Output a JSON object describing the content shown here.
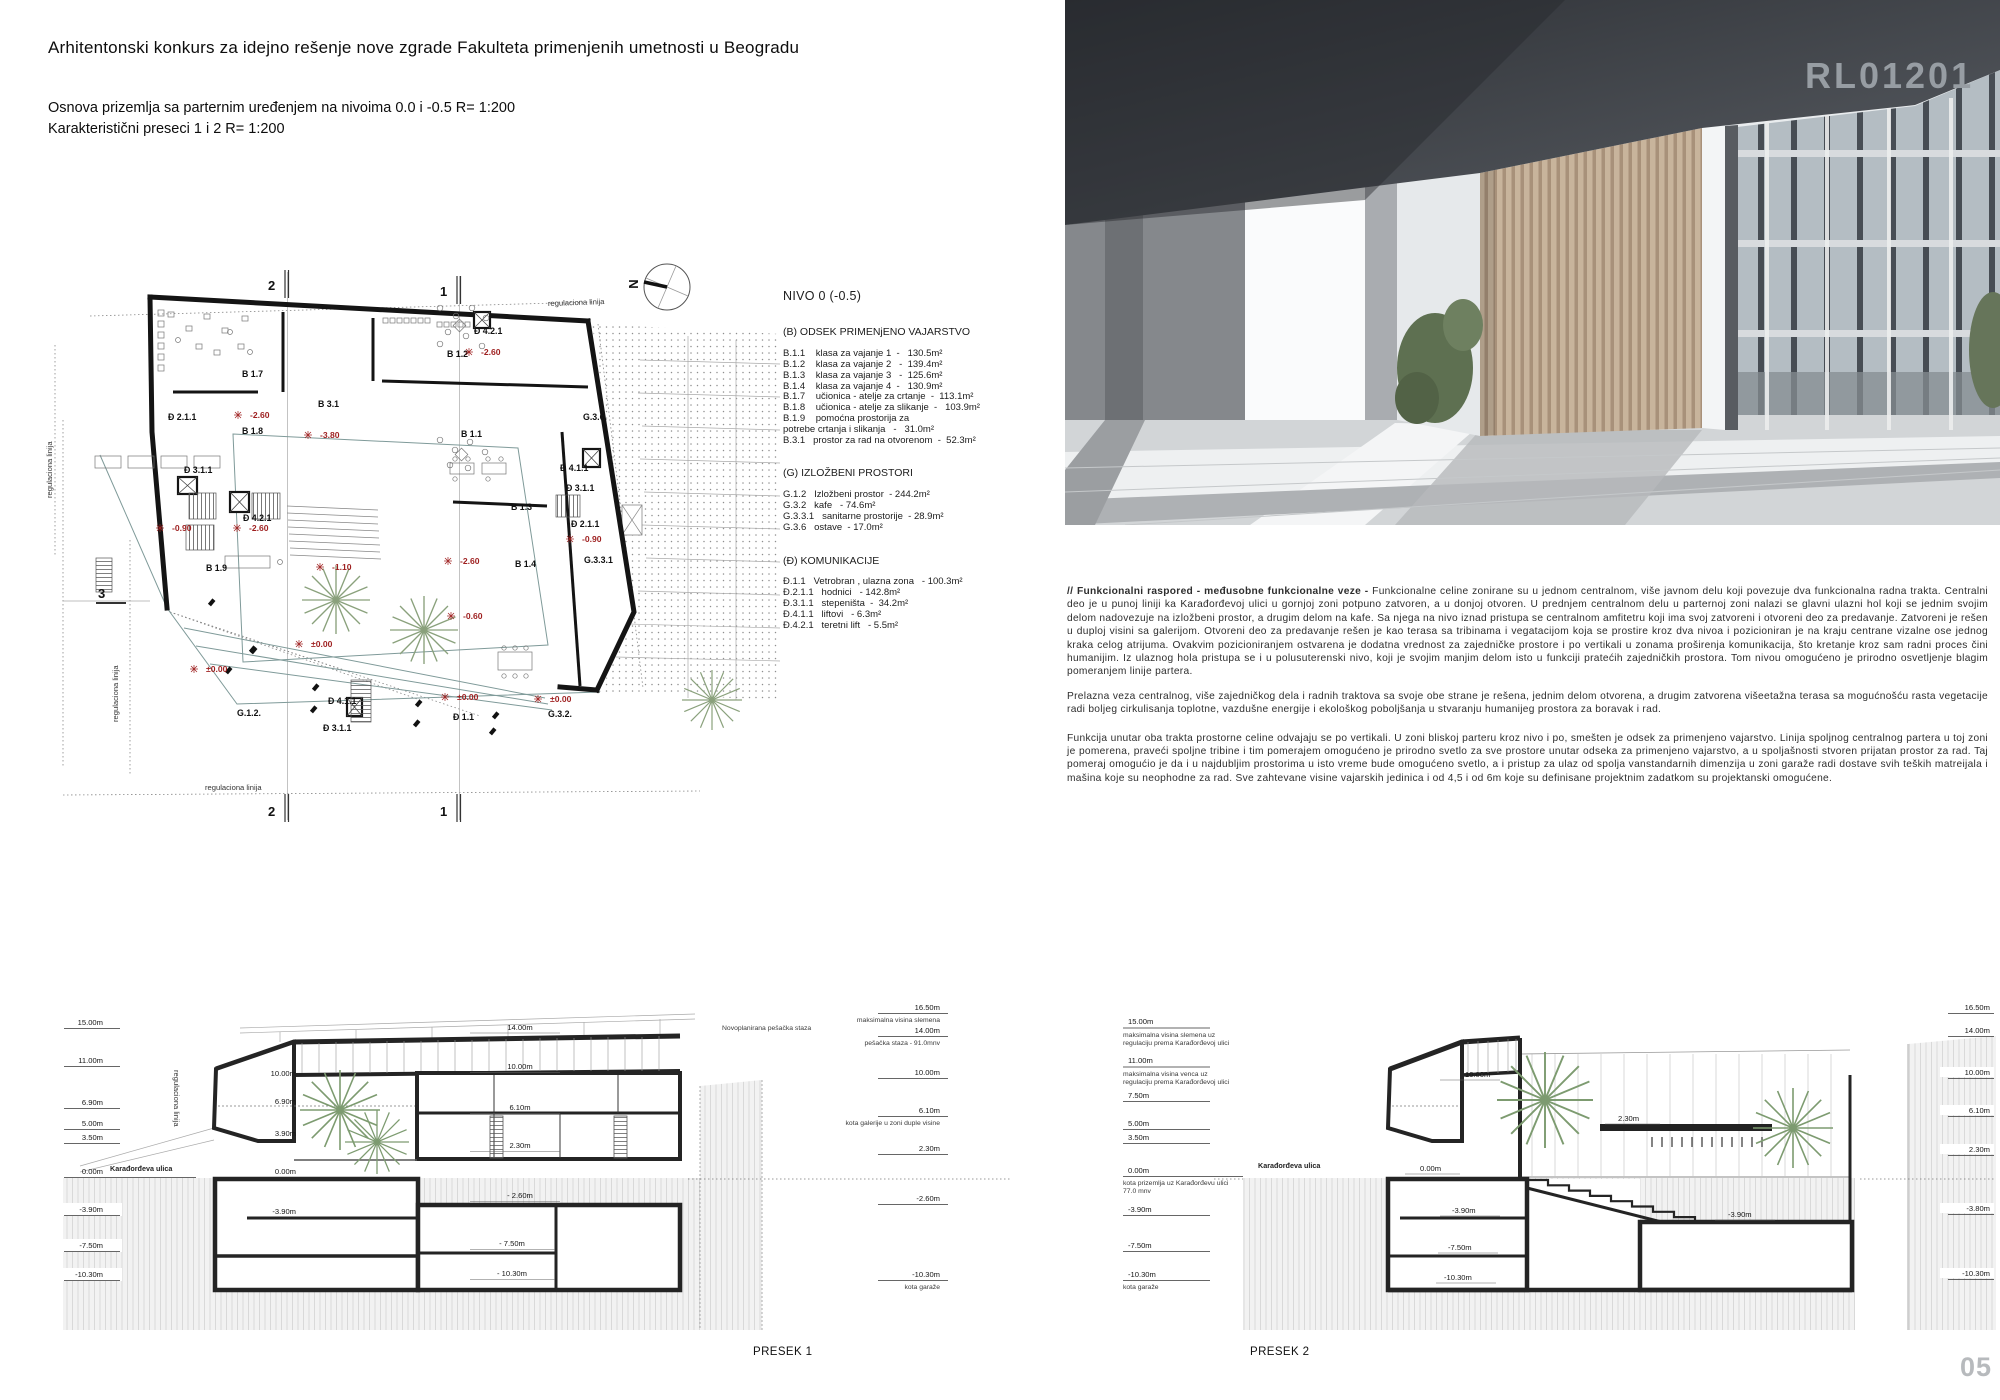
{
  "page": {
    "number": "05"
  },
  "photo": {
    "code": "RL01201"
  },
  "header": {
    "title": "Arhitentonski konkurs za idejno rešenje nove zgrade Fakulteta primenjenih umetnosti u Beogradu",
    "line1": "Osnova prizemlja sa parternim uređenjem na nivoima 0.0 i -0.5    R= 1:200",
    "line2": "Karakteristični preseci 1 i 2     R= 1:200"
  },
  "plan": {
    "compass": "N",
    "reg_label": "regulaciona linija",
    "markers": {
      "m1": "1",
      "m2": "2",
      "m3": "3"
    },
    "rooms": [
      "B 1.7",
      "Đ 2.1.1",
      "B 1.8",
      "B 3.1",
      "B 1.2",
      "Đ 4.2.1",
      "B 1.1",
      "G.3.6.",
      "Đ 4.1.1",
      "Đ 3.1.1",
      "B 1.3",
      "Đ 2.1.1",
      "G.3.3.1",
      "B 1.4",
      "Đ 3.1.1",
      "Đ 4.2.1",
      "B 1.9",
      "G.1.2.",
      "Đ 4.1.1",
      "Đ 3.1.1",
      "Đ 1.1",
      "G.3.2."
    ],
    "levels": [
      "-2.60",
      "-3.80",
      "-2.60",
      "-0.90",
      "-2.60",
      "-0.60",
      "-0.90",
      "-2.60",
      "-1.10",
      "±0.00",
      "±0.00",
      "±0.00",
      "±0.00"
    ]
  },
  "program": {
    "title": "NIVO  0  (-0.5)",
    "b_heading": "(B) ODSEK PRIMENjENO VAJARSTVO",
    "b_items": [
      "B.1.1    klasa za vajanje 1  -   130.5m²",
      "B.1.2    klasa za vajanje 2   -  139.4m²",
      "B.1.3    klasa za vajanje 3   -  125.6m²",
      "B.1.4    klasa za vajanje 4  -   130.9m²",
      "B.1.7    učionica - atelje za crtanje  -  113.1m²",
      "B.1.8    učionica - atelje za slikanje  -   103.9m²",
      "B.1.9    pomoćna prostorija za",
      "potrebe crtanja i slikanja   -   31.0m²",
      "B.3.1   prostor za rad na otvorenom  -  52.3m²"
    ],
    "g_heading": "(G) IZLOŽBENI PROSTORI",
    "g_items": [
      "G.1.2   Izložbeni prostor  - 244.2m²",
      "G.3.2   kafe   - 74.6m²",
      "G.3.3.1   sanitarne prostorije  - 28.9m²",
      "G.3.6   ostave  - 17.0m²"
    ],
    "d_heading": "(Đ) KOMUNIKACIJE",
    "d_items": [
      "Đ.1.1   Vetrobran , ulazna zona   - 100.3m²",
      "Đ.2.1.1   hodnici   - 142.8m²",
      "Đ.3.1.1   stepeništa  -  34.2m²",
      "Đ.4.1.1   liftovi   - 6.3m²",
      "Đ.4.2.1   teretni lift   - 5.5m²"
    ]
  },
  "essay": {
    "lead": "//  Funkcionalni raspored - međusobne funkcionalne veze - ",
    "p1_rest": "Funkcionalne celine zonirane su u jednom centralnom, više javnom delu koji povezuje dva funkcionalna radna trakta. Centralni deo je u punoj liniji ka Karađorđevoj ulici u gornjoj zoni potpuno zatvoren, a u donjoj otvoren. U prednjem centralnom delu u parternoj zoni nalazi se glavni ulazni hol koji se jednim svojim delom nadovezuje na izložbeni prostor, a drugim delom na kafe. Sa njega na nivo iznad pristupa se centralnom amfitetru koji ima svoj zatvoreni i otvoreni deo za predavanje. Zatvoreni je rešen u duploj visini sa galerijom. Otvoreni deo za predavanje rešen je kao terasa sa tribinama i vegatacijom koja se prostire  kroz dva nivoa i pozicioniran je na kraju centrane vizalne ose jednog kraka celog atrijuma. Ovakvim pozicioniranjem ostvarena je dodatna vrednost za zajedničke prostore i po vertikali u zonama proširenja komunikacija, što kretanje kroz sam radni proces čini humanijim.  Iz ulaznog hola pristupa se i u polusuterenski nivo, koji je svojim manjim delom isto u funkciji pratećih zajedničkih prostora. Tom nivou omogućeno je prirodno osvetljenje blagim pomeranjem linije partera.",
    "p2": "Prelazna veza centralnog, više zajedničkog dela i radnih traktova sa svoje obe strane je rešena, jednim delom otvorena, a drugim zatvorena višeetažna terasa sa mogućnošću rasta vegetacije radi boljeg cirkulisanja toplotne, vazdušne energije i ekološkog  poboljšanja u stvaranju humanijeg prostora za boravak i rad.",
    "p3": "Funkcija unutar oba trakta prostorne celine odvajaju se po vertikali. U zoni bliskoj parteru kroz nivo i po, smešten je odsek za primenjeno vajarstvo. Linija spoljnog centralnog partera u toj zoni je pomerena, praveći spoljne tribine i tim pomerajem omogućeno je prirodno svetlo za sve prostore unutar odseka za primenjeno vajarstvo, a u spoljašnosti stvoren prijatan prostor za rad. Taj pomeraj omogućio je da i u najdubljim prostorima u isto vreme bude omogućeno svetlo, a i pristup za ulaz od spolja vanstandarnih dimenzija u zoni garaže radi dostave svih teških matreijala i mašina koje su neophodne za rad. Sve zahtevane visine vajarskih jedinica i od 4,5 i od 6m koje su definisane projektnim zadatkom su projektanski omogućene."
  },
  "presek1": {
    "label": "PRESEK 1",
    "street": "Karađorđeva ulica",
    "path_note": "Novoplanirana pešačka staza",
    "left": [
      "15.00m",
      "11.00m",
      "6.90m",
      "5.00m",
      "3.50m",
      "0.00m",
      "-3.90m",
      "-7.50m",
      "-10.30m"
    ],
    "right_vals": [
      "16.50m",
      "14.00m",
      "10.00m",
      "6.10m",
      "2.30m",
      "-2.60m",
      "-10.30m"
    ],
    "right_notes": [
      "maksimalna visina slemena",
      "pešačka staza  - 91.0mnv",
      "kota galerije u zoni duple visine",
      "kota garaže"
    ],
    "inner_right": [
      "14.00m",
      "10.00m",
      "6.10m",
      "2.30m",
      "- 2.60m",
      "- 7.50m",
      "- 10.30m"
    ],
    "inner_left": [
      "10.00m",
      "6.90m",
      "3.90m",
      "0.00m",
      "-3.90m"
    ]
  },
  "presek2": {
    "label": "PRESEK 2",
    "street": "Karađorđeva ulica",
    "left_vals": [
      "15.00m",
      "11.00m",
      "7.50m",
      "5.00m",
      "3.50m",
      "0.00m",
      "-3.90m",
      "-7.50m",
      "-10.30m"
    ],
    "left_notes": [
      "maksimalna visina slemena uz",
      "regulaciju prema Karađorđevoj ulici",
      "maksimalna visina venca uz",
      "regulaciju prema Karađorđevoj ulici",
      "kota prizemlja uz Karađorđevu ulici",
      "77.0 mnv",
      "kota garaže"
    ],
    "right_vals": [
      "16.50m",
      "14.00m",
      "10.00m",
      "6.10m",
      "2.30m",
      "-3.80m",
      "-10.30m"
    ],
    "inner": [
      "10.00m",
      "0.00m",
      "2.30m",
      "-3.90m",
      "-7.50m",
      "-10.30m",
      "-3.90m"
    ]
  }
}
